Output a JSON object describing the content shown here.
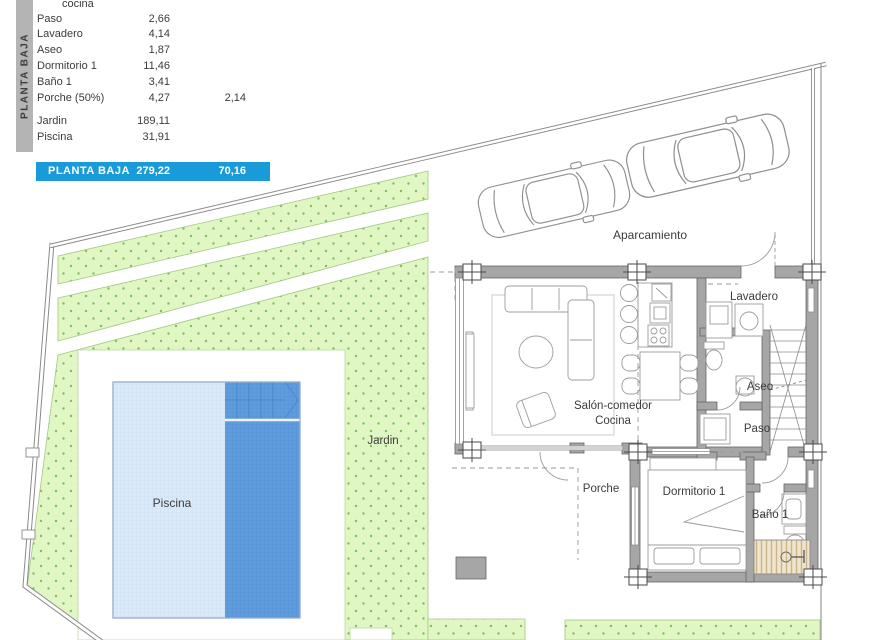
{
  "legend": {
    "sidebar_label": "PLANTA BAJA",
    "rows": [
      {
        "label": "cocina",
        "value": "",
        "value2": ""
      },
      {
        "label": "Paso",
        "value": "2,66",
        "value2": ""
      },
      {
        "label": "Lavadero",
        "value": "4,14",
        "value2": ""
      },
      {
        "label": "Aseo",
        "value": "1,87",
        "value2": ""
      },
      {
        "label": "Dormitorio 1",
        "value": "11,46",
        "value2": ""
      },
      {
        "label": "Baño 1",
        "value": "3,41",
        "value2": ""
      },
      {
        "label": "Porche (50%)",
        "value": "4,27",
        "value2": "2,14"
      },
      {
        "label": "Jardin",
        "value": "189,11",
        "value2": ""
      },
      {
        "label": "Piscina",
        "value": "31,91",
        "value2": ""
      }
    ],
    "total": {
      "label": "PLANTA BAJA",
      "value": "279,22",
      "value2": "70,16"
    }
  },
  "plan": {
    "labels": {
      "aparcamiento": "Aparcamiento",
      "lavadero": "Lavadero",
      "aseo": "Aseo",
      "paso": "Paso",
      "salon_line1": "Salón-comedor",
      "salon_line2": "Cocina",
      "porche": "Porche",
      "dormitorio": "Dormitorio 1",
      "bano": "Baño 1",
      "jardin": "Jardin",
      "piscina": "Piscina"
    }
  },
  "colors": {
    "accent_blue": "#189bd8",
    "sidebar_gray": "#b4b4b4",
    "garden_green": "#e0f6c3",
    "garden_dot_green": "#82be62",
    "pool_light_blue": "#daeaf8",
    "pool_dark_blue": "#5f9cdc",
    "wall_gray": "#a6a6a6",
    "deck_tan": "#f0e5cc",
    "text_gray": "#3c3c3c"
  }
}
